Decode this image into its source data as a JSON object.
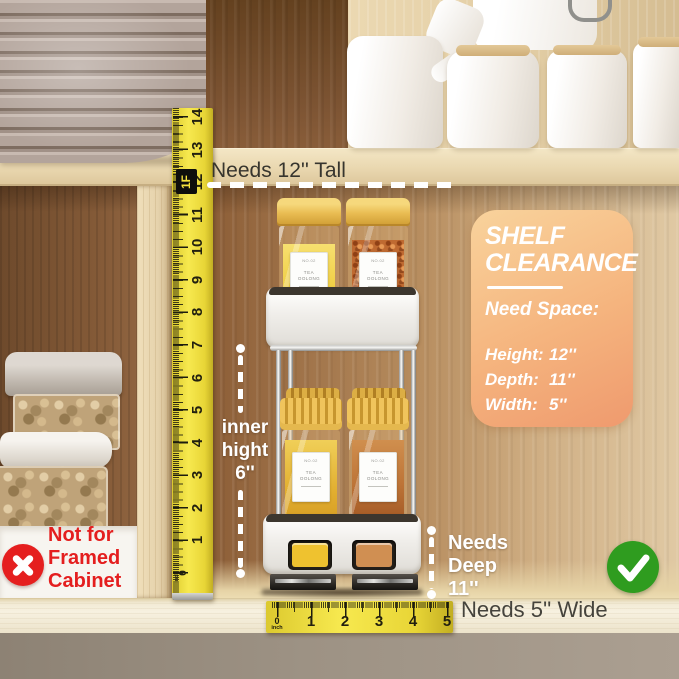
{
  "annotations": {
    "needs_tall": "Needs 12'' Tall",
    "inner_height": [
      "inner",
      "hight",
      "6''"
    ],
    "needs_deep": [
      "Needs",
      "Deep",
      "11''"
    ],
    "needs_wide": "Needs 5'' Wide",
    "not_for": [
      "Not for",
      "Framed",
      "Cabinet"
    ]
  },
  "clearance_card": {
    "title_line1": "SHELF",
    "title_line2": "CLEARANCE",
    "subtitle": "Need Space:",
    "specs": [
      {
        "label": "Height:",
        "value": "12''"
      },
      {
        "label": "Depth:",
        "value": "11''"
      },
      {
        "label": "Width:",
        "value": "5''"
      }
    ],
    "bg_top": "#f9d39c",
    "bg_bottom": "#ef9a6e"
  },
  "vertical_ruler": {
    "numbers": [
      "14",
      "13",
      "12",
      "11",
      "10",
      "9",
      "8",
      "7",
      "6",
      "5",
      "4",
      "3",
      "2",
      "1",
      "0"
    ],
    "foot_marker": "1F",
    "unit": "inch",
    "color": "#f0dd3a"
  },
  "horizontal_ruler": {
    "numbers": [
      "0",
      "1",
      "2",
      "3",
      "4",
      "5"
    ],
    "unit": "inch",
    "color": "#f0dd3a"
  },
  "jar_label": {
    "no": "NO.02",
    "name_line1": "TEA",
    "name_line2": "OOLONG"
  },
  "status": {
    "check_color": "#2f9c1f",
    "cross_color": "#e51f1f"
  }
}
